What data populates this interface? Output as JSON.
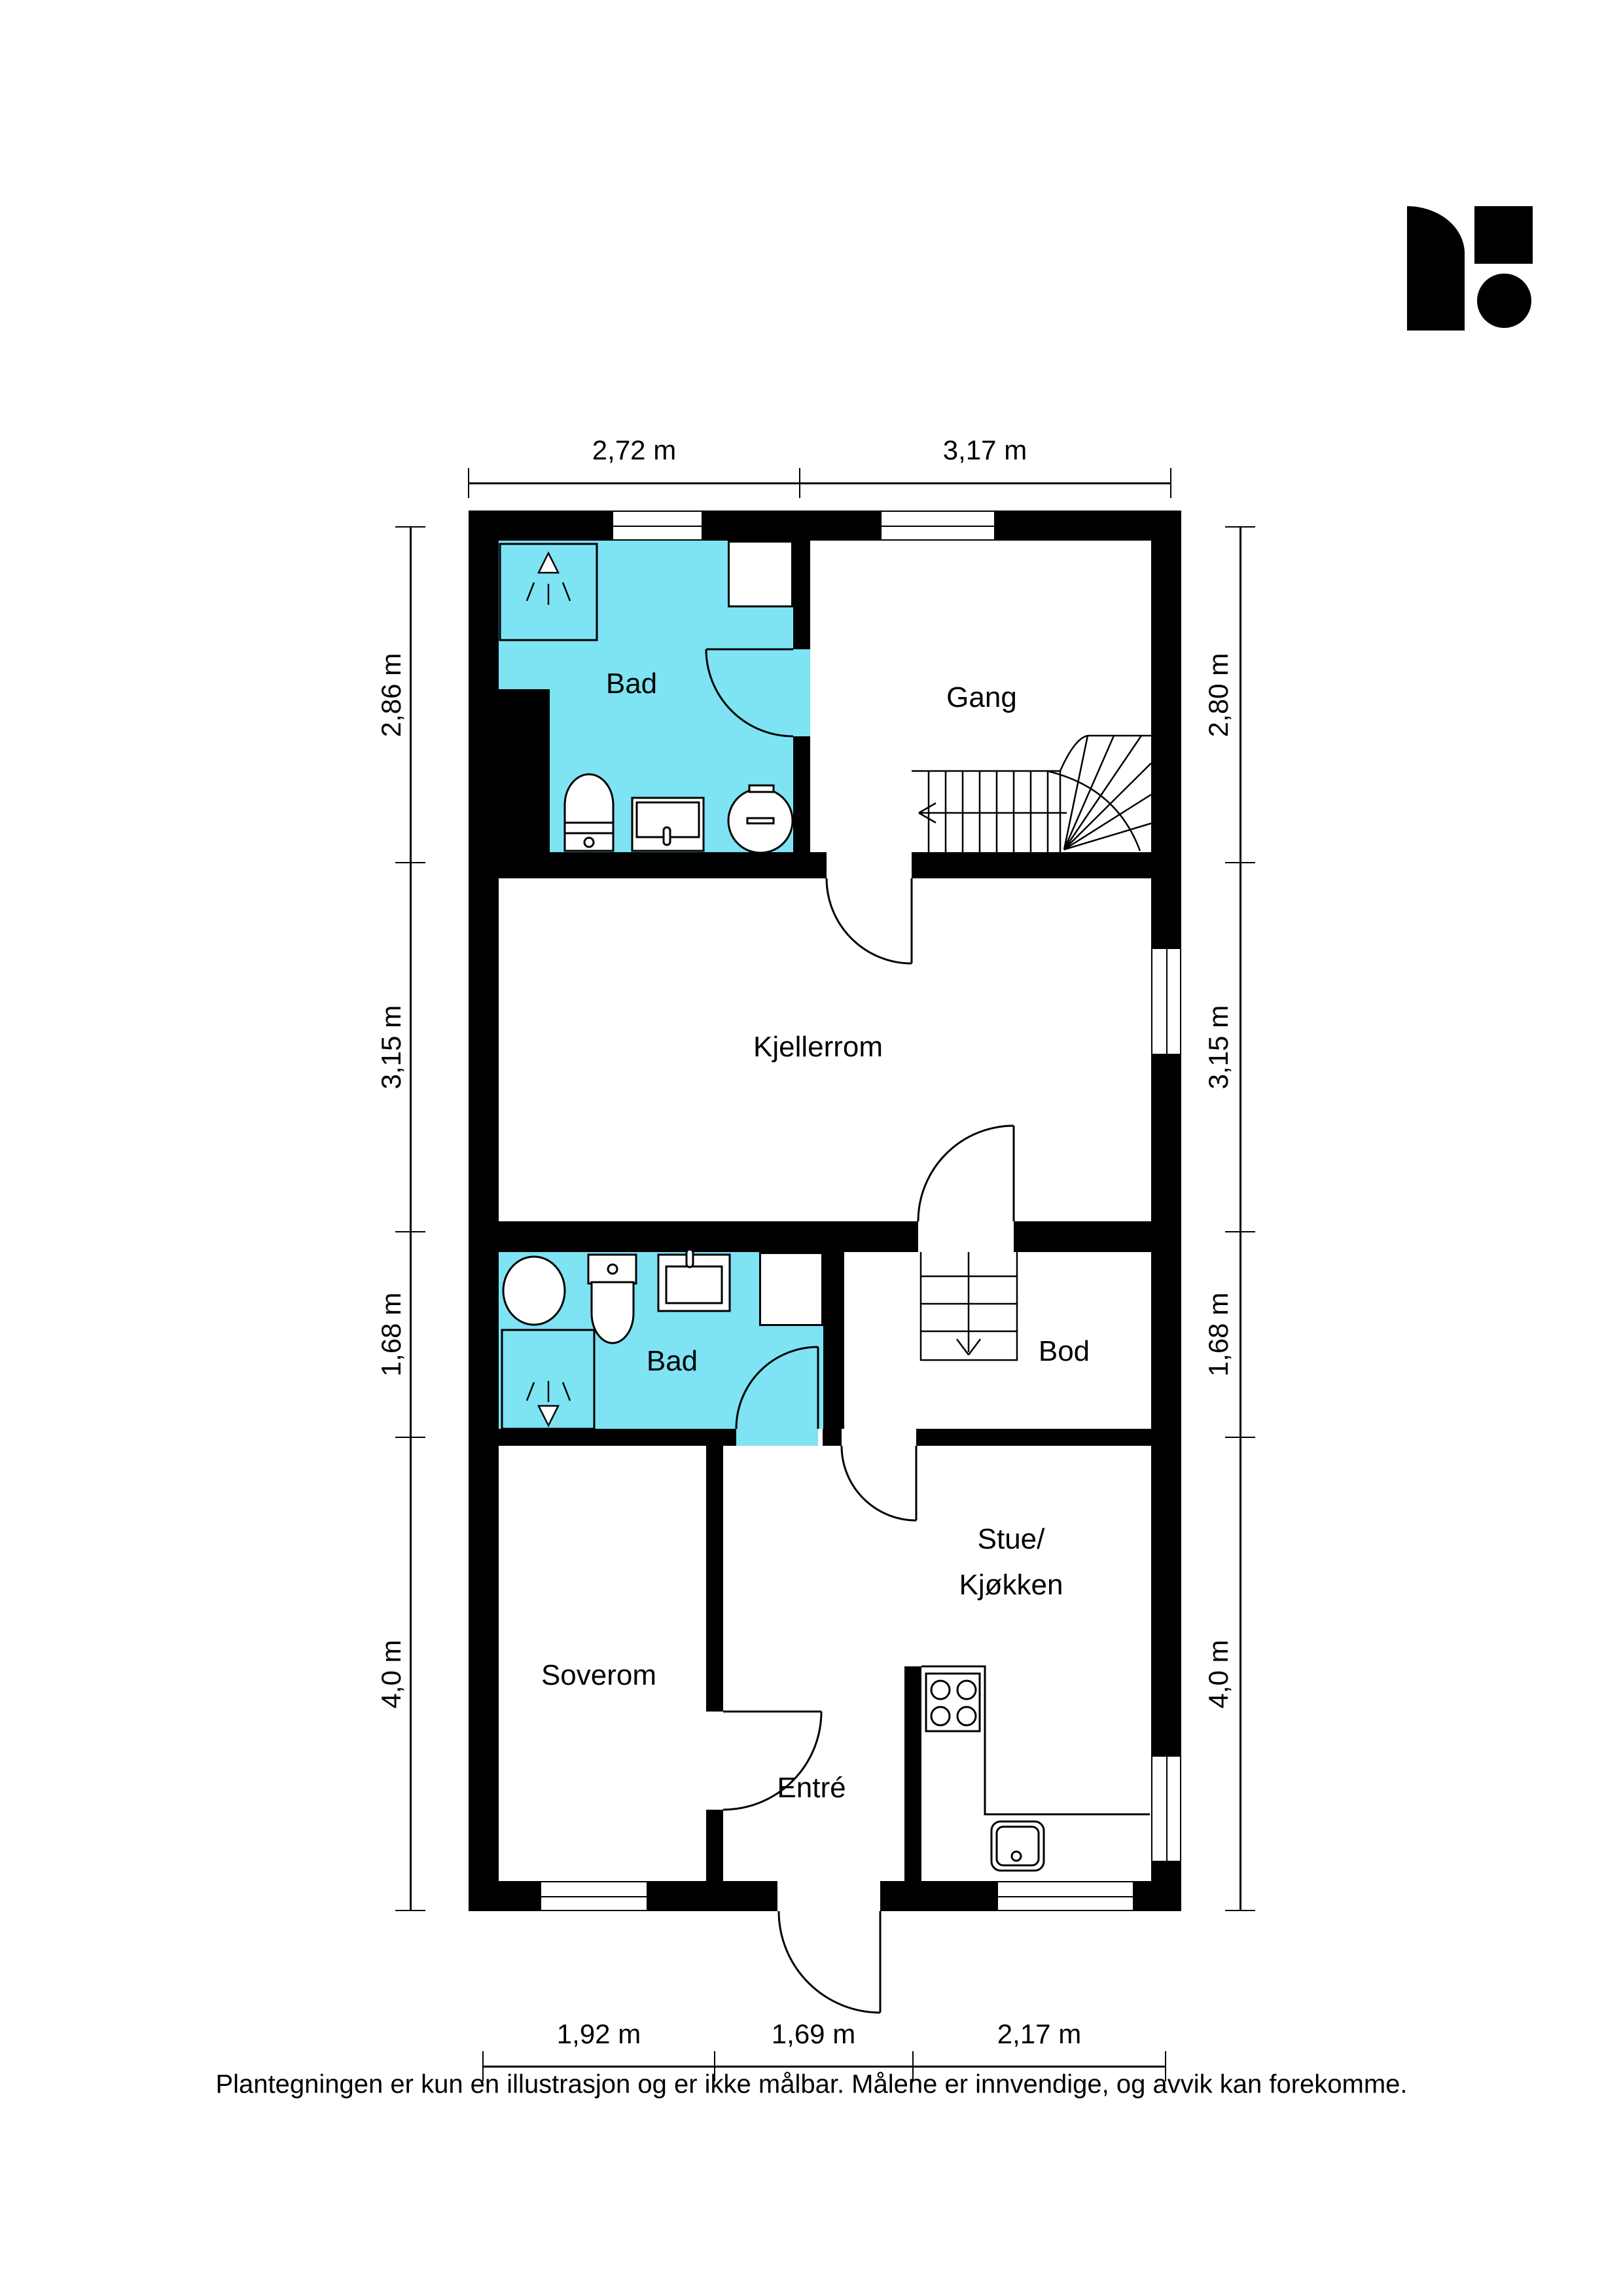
{
  "colors": {
    "bathroom_fill": "#7ee3f3",
    "wall": "#000000"
  },
  "rooms": [
    {
      "id": "bad-top",
      "label": "Bad"
    },
    {
      "id": "gang",
      "label": "Gang"
    },
    {
      "id": "kjellerrom",
      "label": "Kjellerrom"
    },
    {
      "id": "bad-lower",
      "label": "Bad"
    },
    {
      "id": "bod",
      "label": "Bod"
    },
    {
      "id": "soverom",
      "label": "Soverom"
    },
    {
      "id": "stue-kjokken",
      "label_line1": "Stue/",
      "label_line2": "Kjøkken"
    },
    {
      "id": "entre",
      "label": "Entré"
    }
  ],
  "dimensions": {
    "top": [
      "2,72 m",
      "3,17 m"
    ],
    "bottom": [
      "1,92 m",
      "1,69 m",
      "2,17 m"
    ],
    "left": [
      "2,86 m",
      "3,15 m",
      "1,68 m",
      "4,0 m"
    ],
    "right": [
      "2,80 m",
      "3,15 m",
      "1,68 m",
      "4,0 m"
    ]
  },
  "icons": [
    "shower-head-icon",
    "toilet-icon",
    "sink-icon",
    "washing-machine-icon",
    "stove-icon",
    "kitchen-sink-icon",
    "stairs-up-icon",
    "stairs-down-icon"
  ],
  "disclaimer": "Plantegningen er kun en illustrasjon og er ikke målbar. Målene er innvendige, og avvik kan forekomme."
}
